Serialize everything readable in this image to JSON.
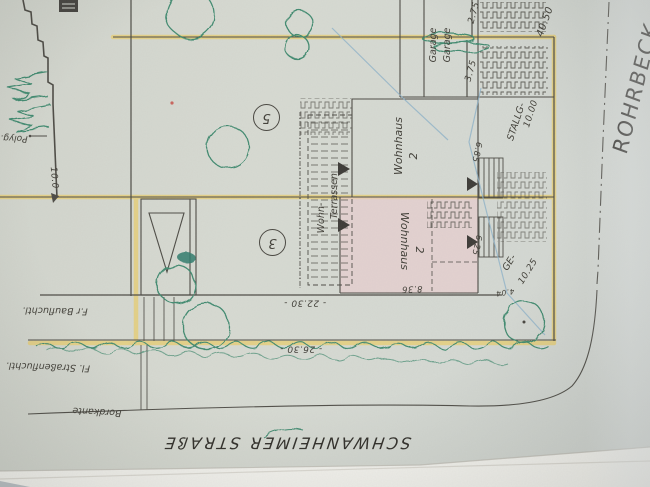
{
  "labels": {
    "street_bottom": "SCHWANHEIMER STRAßE",
    "street_right": "ROHRBECK",
    "bordkante": "Bordkante",
    "strassenfluchtlinie": "Fl. Straßenfluchtl.",
    "baufluchtlinie": "F.r Baufluchtl.",
    "polygon_point": "Polyg.",
    "parcel_5": "5",
    "parcel_3": "3",
    "wohnhaus": "Wohnhaus",
    "wohnhaus_no": "2",
    "wohn": "Wohn-",
    "terrassen": "Terrassen",
    "garage": "Garage",
    "stallg": "STALLG-",
    "ge": "GE-"
  },
  "dimensions": {
    "left_boundary": "10.0",
    "front_building_line": "- 22.30 -",
    "street_frontage": "- 26.30 -",
    "right_boundary": "40.50",
    "garage_top": "2.75",
    "garage_bottom": "3.75",
    "stall_depth": "10.00",
    "ge_depth": "10.25",
    "entry_upper": "6.85",
    "entry_lower": "6.25",
    "house_width": "8.36",
    "corner_offset": "4.04"
  },
  "colors": {
    "paper": "#d5d8d0",
    "ink": "#4c4a44",
    "highlight_yellow": "#e6cf7d",
    "plan_pink": "#eccccf",
    "sketch_green": "#418a6f",
    "pencil_blue": "#8fb3c9"
  }
}
